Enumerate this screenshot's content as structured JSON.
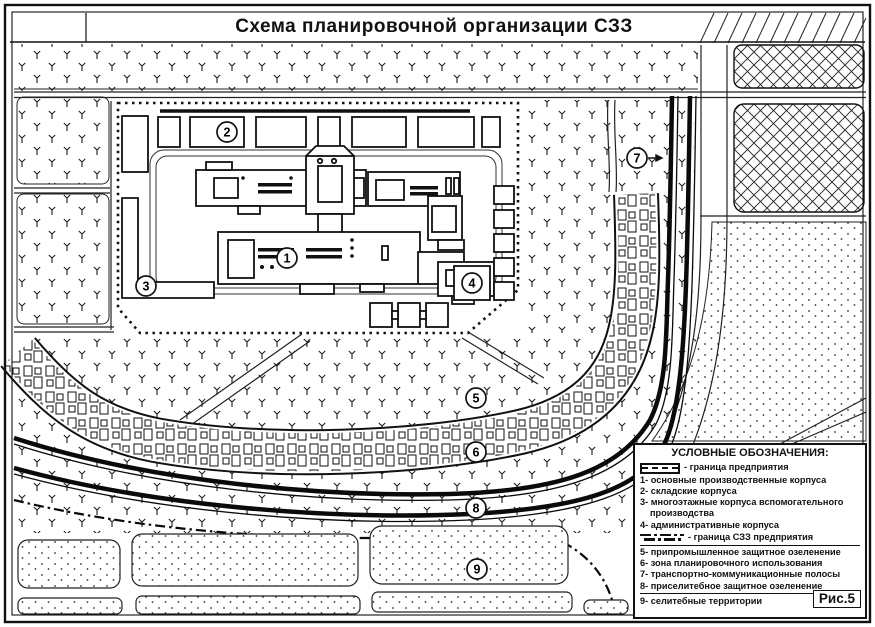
{
  "title": "Схема планировочной организации СЗЗ",
  "figure_label": "Рис.5",
  "map_markers": [
    "1",
    "2",
    "3",
    "4",
    "5",
    "6",
    "7",
    "8",
    "9"
  ],
  "legend": {
    "title": "УСЛОВНЫЕ ОБОЗНАЧЕНИЯ:",
    "enterprise_boundary_label": "- граница предприятия",
    "szz_boundary_label": "- граница СЗЗ предприятия",
    "items": [
      "1- основные производственные корпуса",
      "2- складские корпуса",
      "3- многоэтажные корпуса вспомогательного производства",
      "4- административные корпуса",
      "5- припромышленное защитное озеленение",
      "6- зона планировочного использования",
      "7- транспортно-коммуникационные полосы",
      "8- приселитебное защитное озеленение",
      "9- селитебные территории"
    ]
  },
  "colors": {
    "ink": "#1a1a1a",
    "paper": "#ffffff"
  }
}
